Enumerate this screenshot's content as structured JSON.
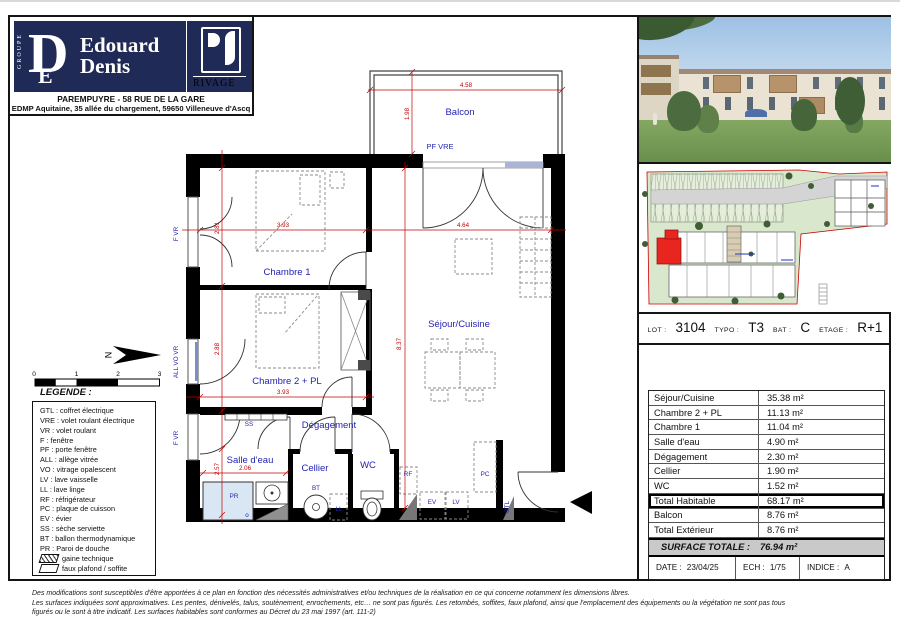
{
  "header": {
    "brand_group": "GROUPE",
    "brand_monogram_d": "D",
    "brand_monogram_e": "E",
    "brand_name_line1": "Edouard",
    "brand_name_line2": "Denis",
    "brand_secondary": "RIVAGE",
    "address_line1": "PAREMPUYRE - 58 RUE DE LA GARE",
    "address_line2": "EDMP Aquitaine, 35 allée du chargement, 59650 Villeneuve d'Ascq"
  },
  "plan": {
    "rooms": {
      "balcon": "Balcon",
      "chambre1": "Chambre 1",
      "chambre2": "Chambre 2 + PL",
      "sejour": "Séjour/Cuisine",
      "degagement": "Dégagement",
      "salle_eau": "Salle d'eau",
      "cellier": "Cellier",
      "wc": "WC"
    },
    "labels": {
      "pf_vre": "PF VRE",
      "f_vr_top": "F VR",
      "all_vo_vr": "ALL VO VR",
      "f_vr_bottom": "F VR",
      "ss": "SS",
      "pr": "PR",
      "o": "o",
      "bt": "BT",
      "ll": "LL",
      "rf": "RF",
      "ev": "EV",
      "lv": "LV",
      "pc": "PC",
      "gtl": "GTL"
    },
    "dimensions": {
      "balcon_width": "4.58",
      "balcon_depth": "1.98",
      "chambre1_width": "3.93",
      "chambre1_depth": "2.81",
      "chambre2_width": "3.93",
      "chambre2_depth": "2.88",
      "sejour_width": "4.64",
      "sejour_depth": "8.37",
      "salle_eau_width": "2.06",
      "salle_eau_depth": "2.57"
    },
    "north_letter": "N",
    "scale_ticks": [
      "0",
      "1",
      "2",
      "3"
    ]
  },
  "legend": {
    "title": "LEGENDE :",
    "items": [
      "GTL : coffret électrique",
      "VRE : volet roulant électrique",
      "VR : volet roulant",
      "F : fenêtre",
      "PF : porte fenêtre",
      "ALL : allège vitrée",
      "VO : vitrage opalescent",
      "LV : lave vaisselle",
      "LL : lave linge",
      "RF : réfrigérateur",
      "PC : plaque de cuisson",
      "EV : évier",
      "SS : sèche serviette",
      "BT : ballon thermodynamique",
      "PR : Paroi de douche"
    ],
    "gaine": "gaine technique",
    "faux": "faux plafond / soffite"
  },
  "unit_info": {
    "lot_label": "LOT :",
    "lot": "3104",
    "typo_label": "TYPO :",
    "typo": "T3",
    "bat_label": "BAT :",
    "bat": "C",
    "etage_label": "ETAGE :",
    "etage": "R+1"
  },
  "surface_table": {
    "rows": [
      {
        "label": "Séjour/Cuisine",
        "value": "35.38 m²"
      },
      {
        "label": "Chambre 2 + PL",
        "value": "11.13 m²"
      },
      {
        "label": "Chambre 1",
        "value": "11.04 m²"
      },
      {
        "label": "Salle d'eau",
        "value": "4.90 m²"
      },
      {
        "label": "Dégagement",
        "value": "2.30 m²"
      },
      {
        "label": "Cellier",
        "value": "1.90 m²"
      },
      {
        "label": "WC",
        "value": "1.52 m²"
      },
      {
        "label": "Total Habitable",
        "value": "68.17 m²"
      },
      {
        "label": "Balcon",
        "value": "8.76 m²"
      },
      {
        "label": "Total Extérieur",
        "value": "8.76 m²"
      }
    ],
    "total_label": "SURFACE TOTALE :",
    "total_value": "76.94 m²"
  },
  "title_block": {
    "date_label": "DATE :",
    "date": "23/04/25",
    "ech_label": "ECH :",
    "ech": "1/75",
    "indice_label": "INDICE :",
    "indice": "A"
  },
  "disclaimer": {
    "line1": "Des modifications sont susceptibles d'être apportées à ce plan en fonction des nécessités administratives et/ou techniques de la réalisation en ce qui concerne notamment les dimensions libres.",
    "line2": "Les surfaces indiquées sont approximatives. Les pentes, dénivelés, talus, soutènement, enrochements, etc… ne sont pas figurés. Les retombés, soffites, faux plafond, ainsi que l'emplacement des équipements ou la végétation ne sont pas tous",
    "line3": "figurés ou le sont à titre indicatif. Les surfaces habitables sont conformes au Décret du 23 mai 1997 (art. 111-2)"
  },
  "colors": {
    "brand_navy": "#1f2a56",
    "label_blue": "#2323b0",
    "dimension_red": "#c40000",
    "highlight_red": "#e8251f",
    "total_row_gray": "#c9c9c9"
  }
}
